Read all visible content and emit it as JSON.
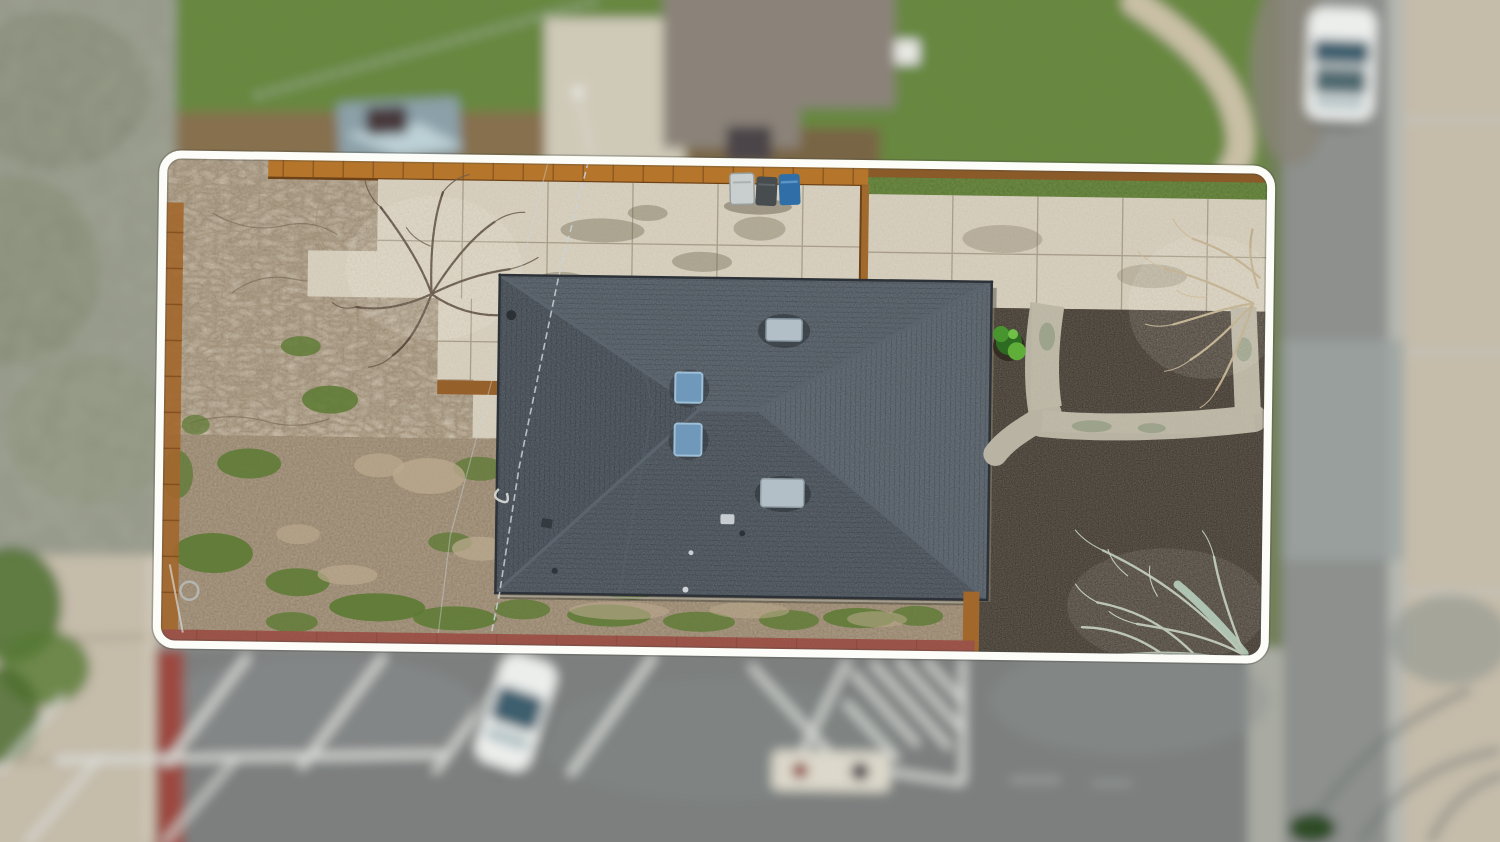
{
  "scene": {
    "type": "aerial-drone-photo",
    "subject": "Top-down drone photograph of a residential lot with a dark hip-roof house, outlined by a white property boundary; blurred neighboring yards, street and parking lot around it",
    "features": [
      "white rounded property boundary outline",
      "dark gray hip roof with two ridge apexes",
      "two blue skylights and two gray roof vents",
      "concrete patio with scored grid lines",
      "concrete driveway with scored grid lines",
      "three trash bins (light gray, dark gray, blue)",
      "bare dirt yard with green grass patches and dry brush",
      "wooden fences (top, left, interior)",
      "dark mulch beds with curved concrete garden paths",
      "green shrub in mulch bed",
      "leafless tree branches over concrete and mulch",
      "red painted curb strips",
      "overhead power lines crossing the lot",
      "parking lot with white diagonal stall stripes",
      "white car parked in a stall (dark glass roof)",
      "white hatched no-parking zone",
      "pavement marker with red and black dots",
      "white car parked on the street (top right)",
      "neighbor house roof and lawns (blurred)",
      "sidewalk and tree canopy (blurred)"
    ]
  },
  "colors": {
    "boundary": "#fcfdf8",
    "roof-base": "#3f464d",
    "roof-n": "#454d55",
    "roof-s": "#3c434a",
    "roof-e": "#4a525a",
    "roof-w": "#373e45",
    "roof-ridge": "#5b646d",
    "skylight": "#6f98ba",
    "vent": "#b2bfc7",
    "concrete": "#cdc5b3",
    "driveway": "#cbc3b1",
    "garden-path": "#b8b3a3",
    "dirt": "#8c7860",
    "grass": "#5c7a33",
    "mulch": "#2f2820",
    "fence-wood": "#b5762c",
    "curb-red": "#9c4a40",
    "asphalt": "#7b7f7e",
    "stripe-white": "#d9dbd7",
    "car-white": "#eceeec",
    "car-glass": "#3c5f6e",
    "bin-blue": "#2f6ea6",
    "bin-dark": "#474c4f",
    "bin-light": "#c9cfcf",
    "lawn": "#5a7c33",
    "sidewalk": "#c5bcaa",
    "street": "#8d908d",
    "gutter": "#b5b7b1",
    "neighbor-roof": "#8b8379",
    "canopy": "#8f9284",
    "branch-pale": "#bfae8d",
    "branch-sage": "#b7c2b2"
  }
}
